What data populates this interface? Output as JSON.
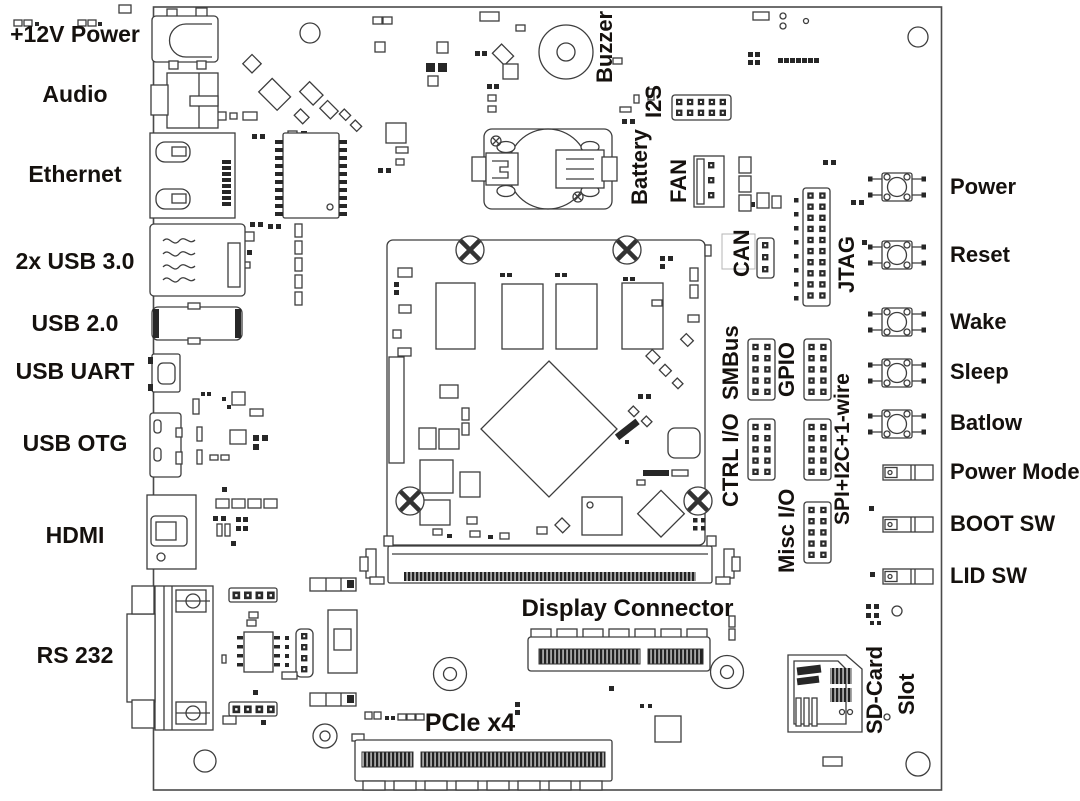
{
  "board": {
    "left_ports": [
      "+12V Power",
      "Audio",
      "Ethernet",
      "2x USB 3.0",
      "USB 2.0",
      "USB UART",
      "USB OTG",
      "HDMI",
      "RS 232"
    ],
    "top_components": [
      "Buzzer",
      "I2S",
      "Battery",
      "FAN",
      "CAN",
      "JTAG"
    ],
    "io_headers": [
      "SMBus",
      "GPIO",
      "CTRL I/O",
      "SPI+I2C+1-wire",
      "Misc I/O"
    ],
    "right_controls": [
      "Power",
      "Reset",
      "Wake",
      "Sleep",
      "Batlow",
      "Power Mode",
      "BOOT SW",
      "LID SW"
    ],
    "bottom_connectors": [
      "Display Connector",
      "PCIe x4"
    ],
    "sd_card_slot": [
      "SD-Card",
      "Slot"
    ],
    "line_color": "#3d3d3d",
    "text_color": "#15110e"
  }
}
